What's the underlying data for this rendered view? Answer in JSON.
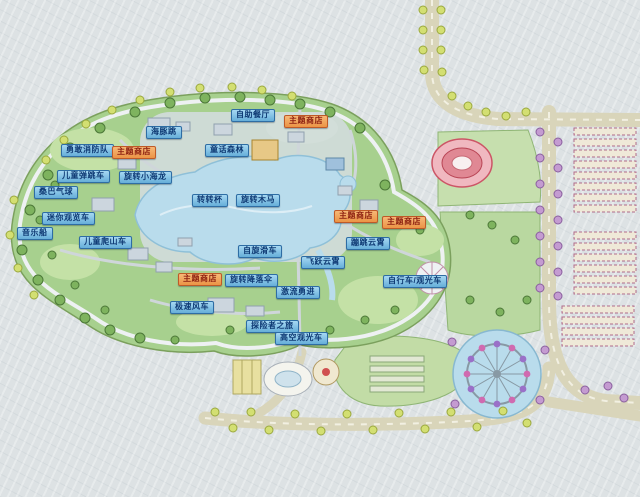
{
  "map": {
    "title": "游乐园导览图",
    "labels": [
      {
        "text": "自助餐厅",
        "style": "blue",
        "x": 231,
        "y": 109
      },
      {
        "text": "主题商店",
        "style": "orange",
        "x": 284,
        "y": 115
      },
      {
        "text": "海豚跳",
        "style": "blue",
        "x": 146,
        "y": 126
      },
      {
        "text": "勇敢消防队",
        "style": "blue",
        "x": 61,
        "y": 144
      },
      {
        "text": "主题商店",
        "style": "orange",
        "x": 112,
        "y": 146
      },
      {
        "text": "童话森林",
        "style": "blue",
        "x": 205,
        "y": 144
      },
      {
        "text": "儿童弹跳车",
        "style": "blue",
        "x": 57,
        "y": 170
      },
      {
        "text": "旋转小海龙",
        "style": "blue",
        "x": 119,
        "y": 171
      },
      {
        "text": "桑巴气球",
        "style": "blue",
        "x": 34,
        "y": 186
      },
      {
        "text": "转转杯",
        "style": "blue",
        "x": 192,
        "y": 194
      },
      {
        "text": "旋转木马",
        "style": "blue",
        "x": 236,
        "y": 194
      },
      {
        "text": "迷你观览车",
        "style": "blue",
        "x": 42,
        "y": 212
      },
      {
        "text": "主题商店",
        "style": "orange",
        "x": 334,
        "y": 210
      },
      {
        "text": "主题商店",
        "style": "orange",
        "x": 382,
        "y": 216
      },
      {
        "text": "音乐船",
        "style": "blue",
        "x": 17,
        "y": 227
      },
      {
        "text": "儿童爬山车",
        "style": "blue",
        "x": 79,
        "y": 236
      },
      {
        "text": "蹦跳云霄",
        "style": "blue",
        "x": 346,
        "y": 237
      },
      {
        "text": "自旋滑车",
        "style": "blue",
        "x": 238,
        "y": 245
      },
      {
        "text": "飞跃云霄",
        "style": "blue",
        "x": 301,
        "y": 256
      },
      {
        "text": "主题商店",
        "style": "orange",
        "x": 178,
        "y": 273
      },
      {
        "text": "旋转降落伞",
        "style": "blue",
        "x": 225,
        "y": 274
      },
      {
        "text": "自行车/观光车",
        "style": "blue",
        "x": 383,
        "y": 275
      },
      {
        "text": "激流勇进",
        "style": "blue",
        "x": 276,
        "y": 286
      },
      {
        "text": "极速风车",
        "style": "blue",
        "x": 170,
        "y": 301
      },
      {
        "text": "探险者之旅",
        "style": "blue",
        "x": 246,
        "y": 320
      },
      {
        "text": "高空观光车",
        "style": "blue",
        "x": 275,
        "y": 332
      }
    ],
    "colors": {
      "label_blue_bg": "#7fc0e4",
      "label_blue_border": "#2e6da4",
      "label_blue_text": "#0f3a74",
      "label_orange_bg": "#f2a45c",
      "label_orange_border": "#bf5a28",
      "label_orange_text": "#8c1f10",
      "park_green": "#a7d08e",
      "lake_blue": "#b9dcec",
      "road_beige": "#ddd9c0",
      "paper_background": "#dde2e4"
    }
  }
}
